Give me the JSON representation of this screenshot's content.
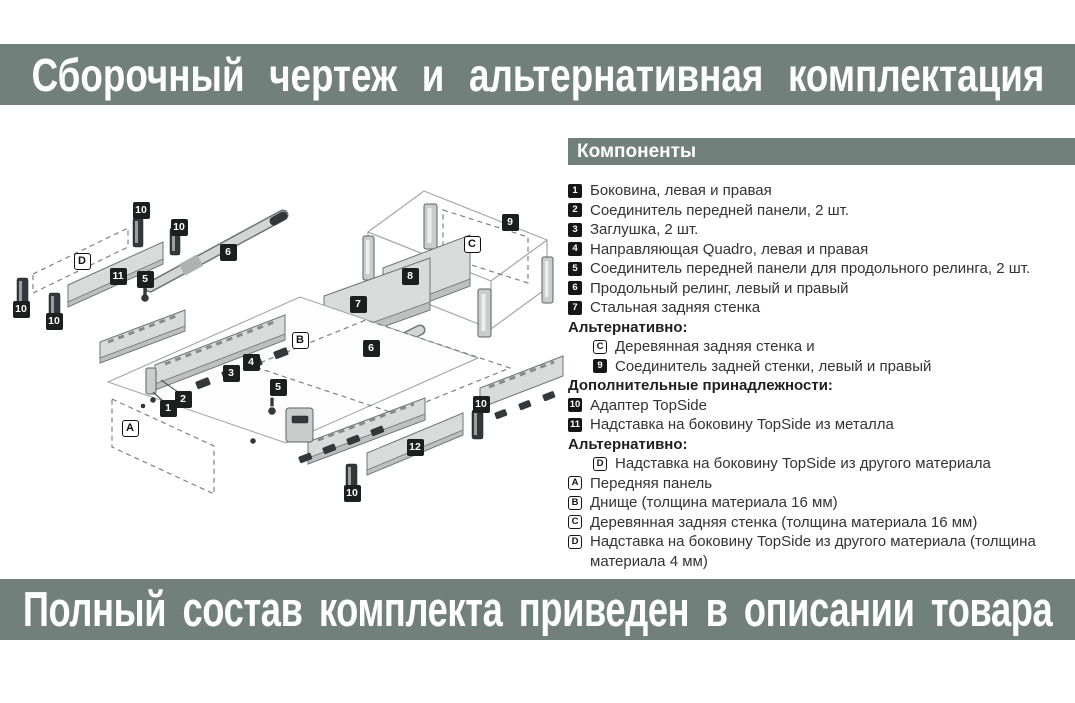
{
  "top_banner": {
    "text": "Сборочный чертеж и альтернативная комплектация"
  },
  "bottom_banner": {
    "text": "Полный состав комплекта приведен в описании товара"
  },
  "components": {
    "header": "Компоненты",
    "items": [
      {
        "marker": "1",
        "type": "num",
        "indent": false,
        "text": "Боковина, левая и правая"
      },
      {
        "marker": "2",
        "type": "num",
        "indent": false,
        "text": "Соединитель передней панели, 2 шт."
      },
      {
        "marker": "3",
        "type": "num",
        "indent": false,
        "text": "Заглушка, 2 шт."
      },
      {
        "marker": "4",
        "type": "num",
        "indent": false,
        "text": "Направляющая Quadro, левая и правая"
      },
      {
        "marker": "5",
        "type": "num",
        "indent": false,
        "text": "Соединитель передней панели для продольного релинга, 2 шт."
      },
      {
        "marker": "6",
        "type": "num",
        "indent": false,
        "text": "Продольный релинг, левый и правый"
      },
      {
        "marker": "7",
        "type": "num",
        "indent": false,
        "text": "Стальная задняя стенка"
      },
      {
        "marker": null,
        "type": "heading",
        "indent": false,
        "text": "Альтернативно:"
      },
      {
        "marker": "C",
        "type": "letter",
        "indent": true,
        "text": "Деревянная задняя стенка и"
      },
      {
        "marker": "9",
        "type": "num",
        "indent": true,
        "text": "Соединитель задней стенки, левый и правый"
      },
      {
        "marker": null,
        "type": "heading",
        "indent": false,
        "text": "Дополнительные принадлежности:"
      },
      {
        "marker": "10",
        "type": "num",
        "indent": false,
        "text": "Адаптер TopSide"
      },
      {
        "marker": "11",
        "type": "num",
        "indent": false,
        "text": "Надставка на боковину TopSide из металла"
      },
      {
        "marker": null,
        "type": "heading",
        "indent": false,
        "text": "Альтернативно:"
      },
      {
        "marker": "D",
        "type": "letter",
        "indent": true,
        "text": "Надставка на боковину TopSide из другого материала"
      },
      {
        "marker": "A",
        "type": "letter",
        "indent": false,
        "text": "Передняя панель"
      },
      {
        "marker": "B",
        "type": "letter",
        "indent": false,
        "text": "Днище (толщина материала 16 мм)"
      },
      {
        "marker": "C",
        "type": "letter",
        "indent": false,
        "text": "Деревянная задняя стенка (толщина материала 16 мм)"
      },
      {
        "marker": "D",
        "type": "letter",
        "indent": false,
        "text": "Надставка на боковину TopSide из другого материала (толщина материала 4 мм)"
      }
    ]
  },
  "diagram": {
    "labels": [
      {
        "text": "10",
        "type": "num",
        "x": 141,
        "y": 80
      },
      {
        "text": "10",
        "type": "num",
        "x": 179,
        "y": 97
      },
      {
        "text": "10",
        "type": "num",
        "x": 21,
        "y": 179
      },
      {
        "text": "10",
        "type": "num",
        "x": 54,
        "y": 191
      },
      {
        "text": "10",
        "type": "num",
        "x": 481,
        "y": 274
      },
      {
        "text": "10",
        "type": "num",
        "x": 352,
        "y": 363
      },
      {
        "text": "11",
        "type": "num",
        "x": 118,
        "y": 146
      },
      {
        "text": "5",
        "type": "num",
        "x": 145,
        "y": 149
      },
      {
        "text": "5",
        "type": "num",
        "x": 278,
        "y": 257
      },
      {
        "text": "6",
        "type": "num",
        "x": 228,
        "y": 122
      },
      {
        "text": "6",
        "type": "num",
        "x": 371,
        "y": 218
      },
      {
        "text": "9",
        "type": "num",
        "x": 510,
        "y": 92
      },
      {
        "text": "8",
        "type": "num",
        "x": 410,
        "y": 146
      },
      {
        "text": "7",
        "type": "num",
        "x": 358,
        "y": 174
      },
      {
        "text": "4",
        "type": "num",
        "x": 251,
        "y": 232
      },
      {
        "text": "3",
        "type": "num",
        "x": 231,
        "y": 243
      },
      {
        "text": "2",
        "type": "num",
        "x": 183,
        "y": 269
      },
      {
        "text": "1",
        "type": "num",
        "x": 168,
        "y": 278
      },
      {
        "text": "12",
        "type": "num",
        "x": 415,
        "y": 317
      },
      {
        "text": "D",
        "type": "letter",
        "x": 82,
        "y": 131
      },
      {
        "text": "C",
        "type": "letter",
        "x": 472,
        "y": 114
      },
      {
        "text": "B",
        "type": "letter",
        "x": 300,
        "y": 210
      },
      {
        "text": "A",
        "type": "letter",
        "x": 130,
        "y": 298
      }
    ]
  },
  "colors": {
    "banner_bg": "#72807b",
    "banner_text": "#ffffff",
    "list_text": "#333333",
    "marker_bg": "#161616",
    "marker_border": "#161616",
    "diagram_outline": "#6f7472"
  }
}
